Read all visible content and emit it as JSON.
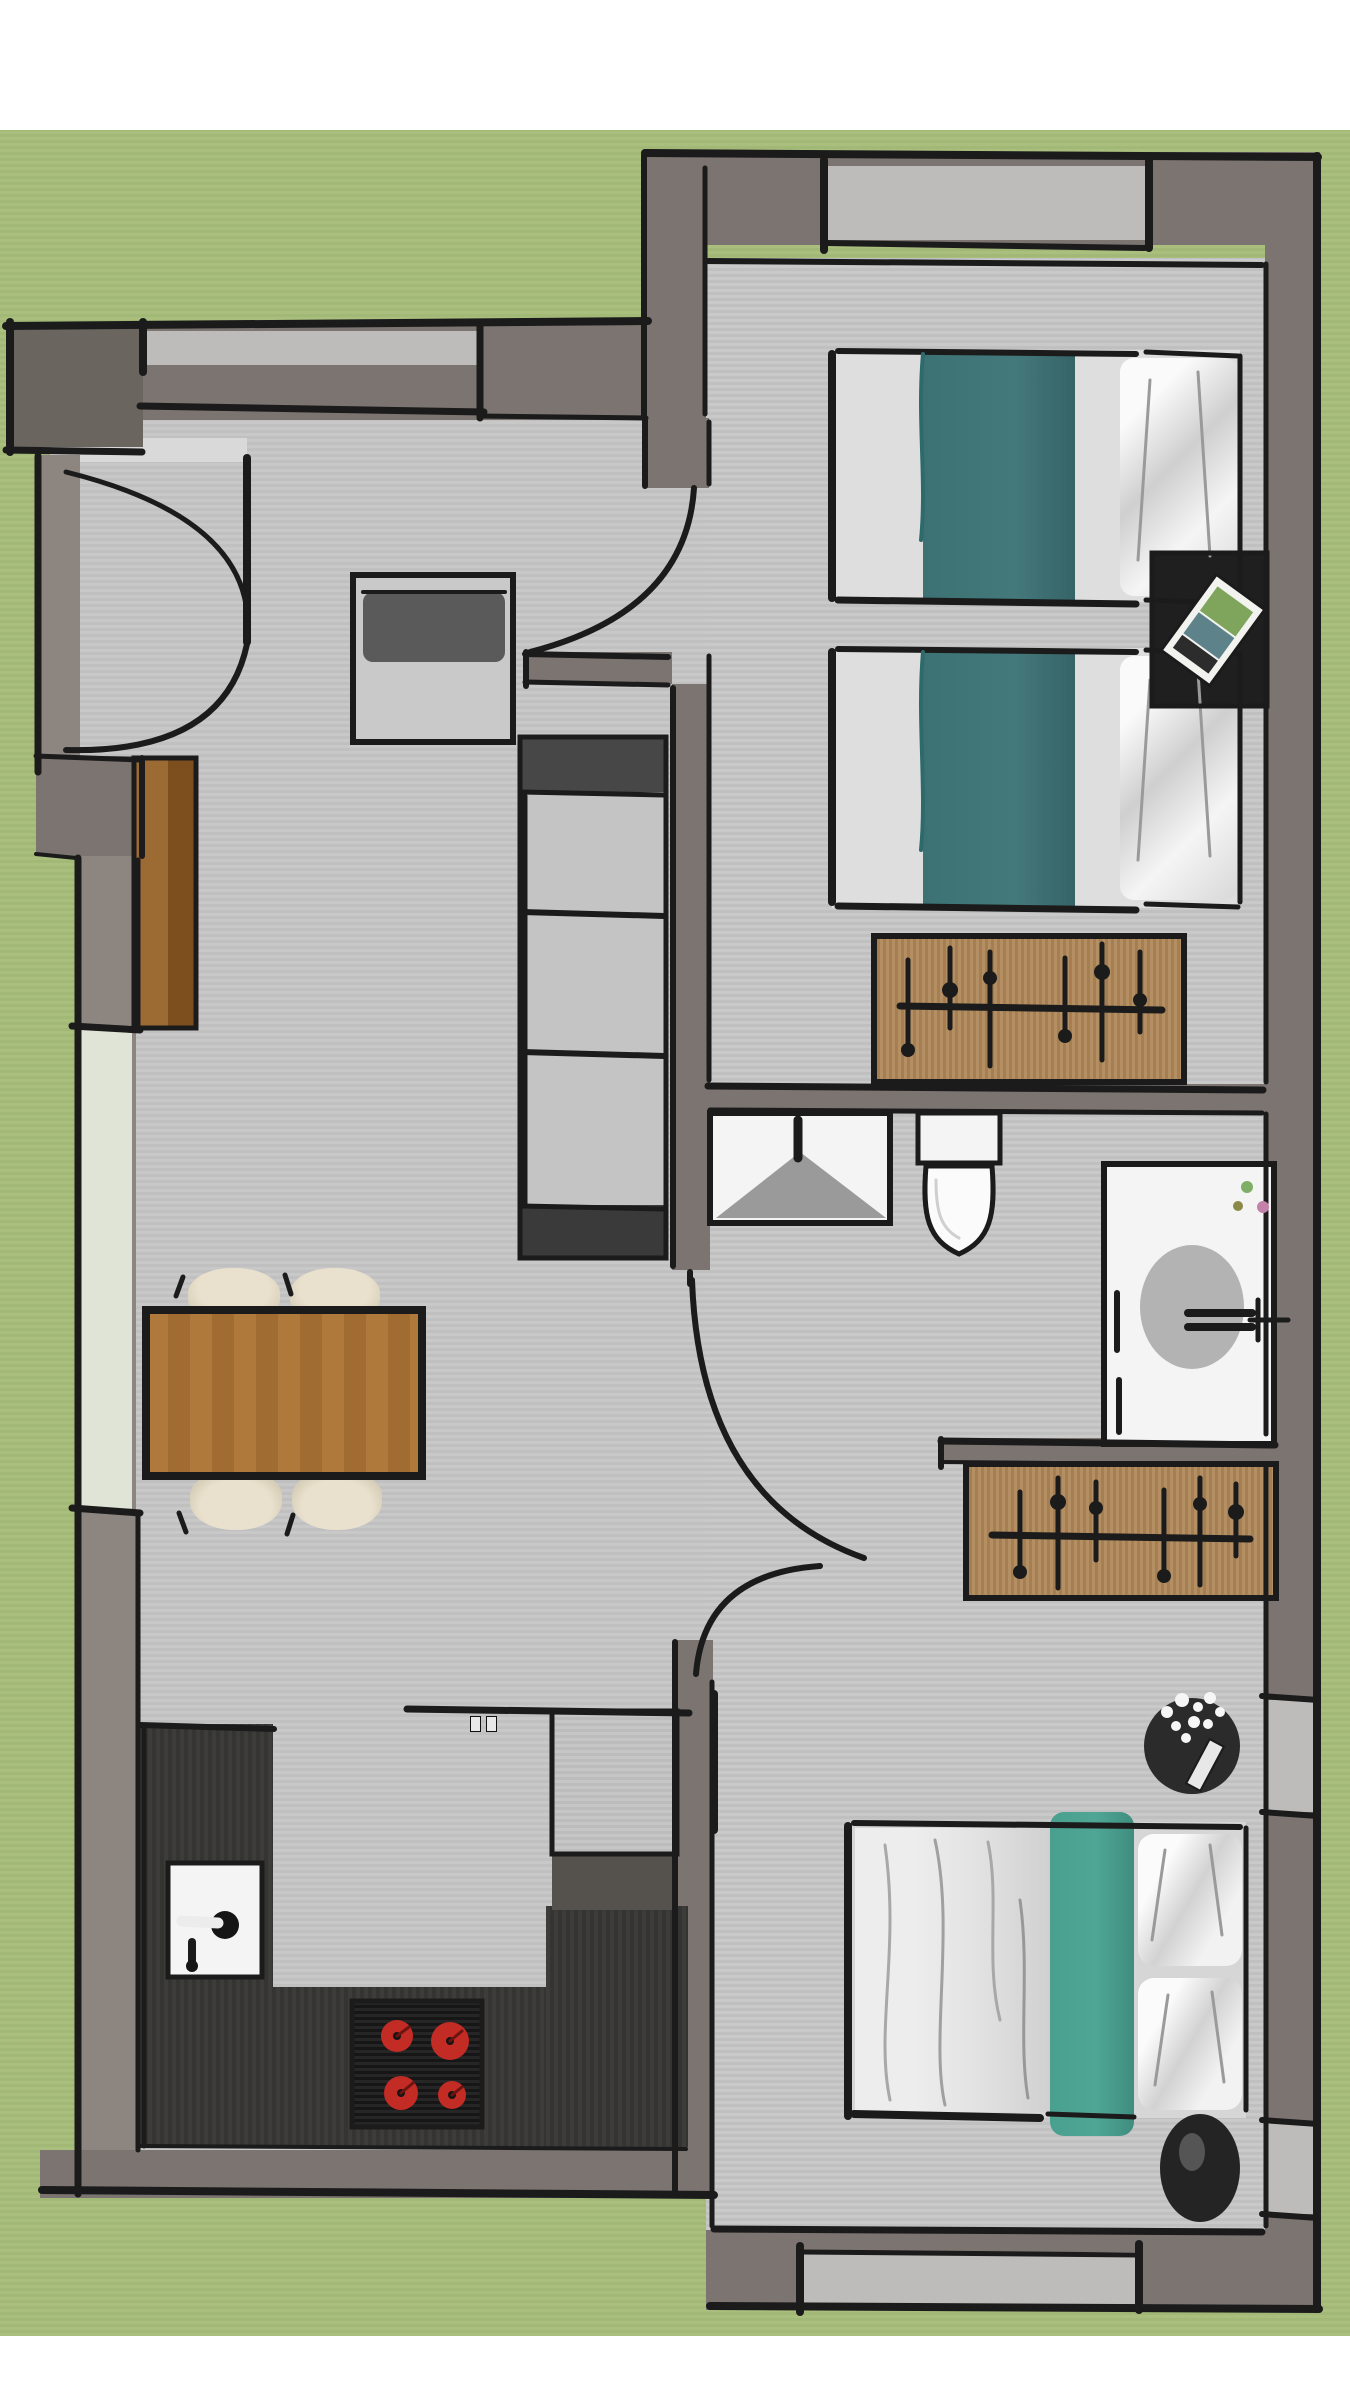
{
  "meta": {
    "kind": "floor-plan",
    "style": "hand-drawn 3D top-view apartment plan on grass background",
    "text_visible": false
  },
  "colors": {
    "paper": "#ffffff",
    "grass": "#aabf7e",
    "grassLine": "#a2b876",
    "floor": "#c8c8c8",
    "floorLine": "#c0c0c0",
    "wall": "#7b7470",
    "wallLight": "#8d8680",
    "wallDark": "#6b655f",
    "window": "#bdbcba",
    "windowGreen": "#dfe4d6",
    "ink": "#1b1b1b",
    "teal": "#44797b",
    "tealBright": "#4fa695",
    "wood": "#b0793c",
    "tan": "#b48f63",
    "charcoal": "#3d3c3a",
    "stove": "#161616",
    "burner": "#c32b25",
    "appliance": "#c6c6c6",
    "cream": "#e9e1cd",
    "white": "#f4f4f4",
    "nightstand": "#1f1f1f",
    "plantTable": "#2b2b2b",
    "duvet": "#e3e3e3",
    "pillow": "#f0f0f0"
  },
  "rooms": [
    {
      "name": "Garden"
    },
    {
      "name": "Living and dining room"
    },
    {
      "name": "Kitchen"
    },
    {
      "name": "Twin bedroom"
    },
    {
      "name": "Bathroom"
    },
    {
      "name": "Double bedroom"
    },
    {
      "name": "Hallway"
    }
  ],
  "furniture": {
    "living": [
      "entry door",
      "armchair",
      "shelving unit",
      "sideboard",
      "dining table",
      "four chairs"
    ],
    "kitchen": [
      "L-shaped counter",
      "sink with faucet",
      "cooktop with four burners",
      "refrigerator"
    ],
    "twin_bedroom": [
      "single bed with teal runner",
      "single bed with teal runner",
      "nightstand with magazine",
      "wardrobe with hanging clothes",
      "window"
    ],
    "bathroom": [
      "washbasin",
      "toilet",
      "bathtub with faucet and flowers",
      "door"
    ],
    "double_bedroom": [
      "double bed with teal runner",
      "wardrobe with hanging clothes",
      "two plant side tables",
      "window"
    ]
  }
}
